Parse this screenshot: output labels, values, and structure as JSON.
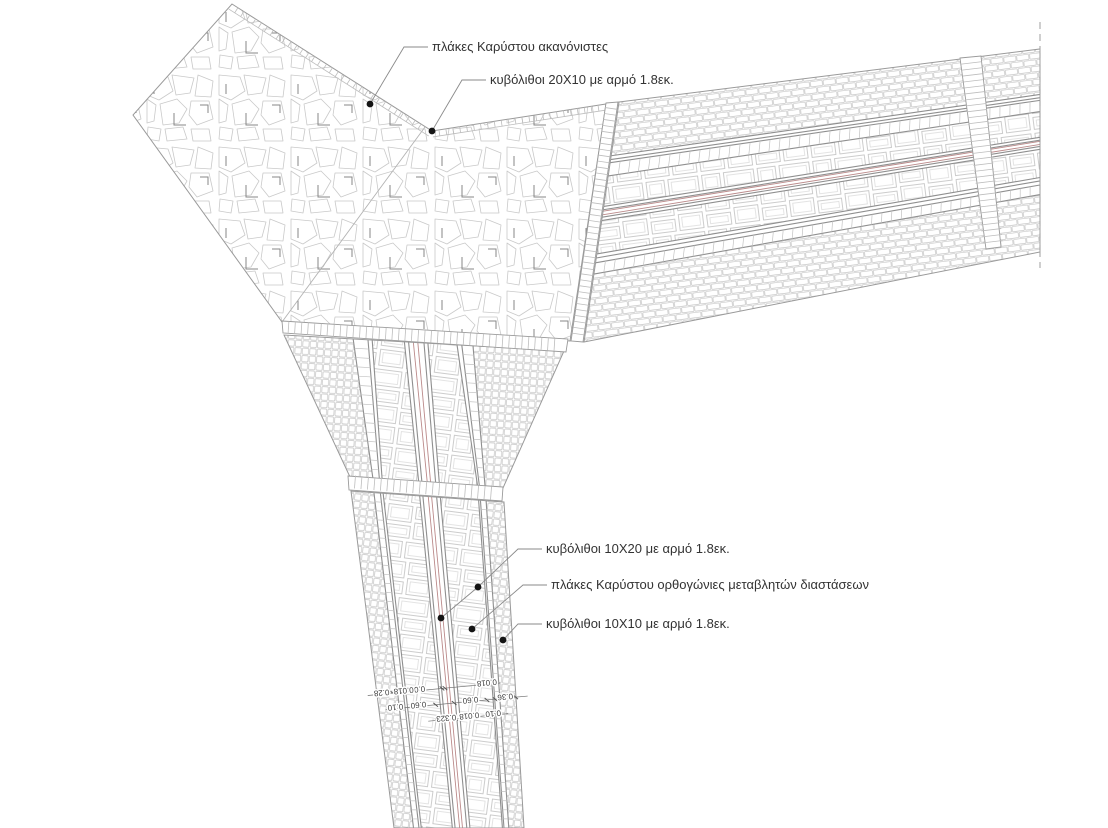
{
  "annotations": {
    "plaza": "πλάκες Καρύστου ακανόνιστες",
    "cobble_20x10": "κυβόλιθοι 20X10 με αρμό 1.8εκ.",
    "cobble_10x20": "κυβόλιθοι 10X20 με αρμό 1.8εκ.",
    "slabs_rect": "πλάκες Καρύστου ορθογώνιες μεταβλητών διαστάσεων",
    "cobble_10x10": "κυβόλιθοι 10X10 με αρμό 1.8εκ."
  },
  "dimensions": {
    "row_top": [
      "0.018",
      "0.02",
      "0.018",
      "0.28"
    ],
    "row_mid": [
      "0.36",
      "0.60",
      "0.60",
      "0.10"
    ],
    "row_bot": [
      "0.10",
      "0.018",
      "0.323"
    ]
  },
  "colors": {
    "accent_red": "#bb8a8a",
    "band_line": "#8f8f8f",
    "pattern_line": "#c7c7c7",
    "dark_mark": "#878787",
    "outline": "#9a9a9a",
    "text": "#333333",
    "dim_text": "#3d3d3d"
  }
}
